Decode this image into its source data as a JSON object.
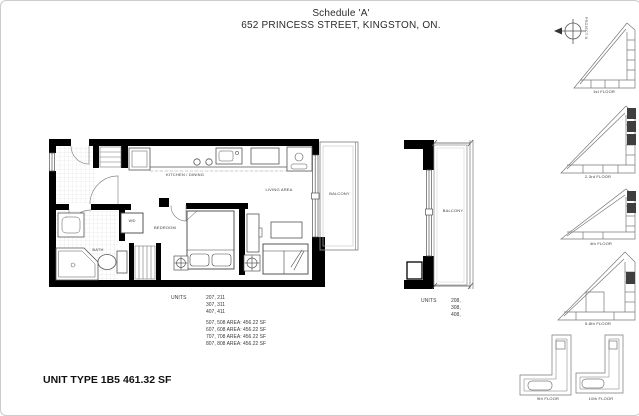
{
  "title": {
    "schedule": "Schedule 'A'",
    "address": "652 PRINCESS STREET, KINGSTON, ON."
  },
  "plan_labels": {
    "kitchen_dining": "KITCHEN / DINING",
    "living_area": "LIVING AREA",
    "bedroom": "BEDROOM",
    "bath": "BATH",
    "washer_dryer": "W/D",
    "balcony": "BALCONY"
  },
  "section_labels": {
    "balcony": "BALCONY"
  },
  "units_left": {
    "label": "UNITS",
    "lines": [
      "207, 211",
      "307, 311",
      "407, 411"
    ],
    "area_lines": [
      "507, 508 AREA: 456.22 SF",
      "607, 608 AREA: 456.22 SF",
      "707, 708 AREA: 456.22 SF",
      "807, 808 AREA: 456.22 SF"
    ]
  },
  "units_right": {
    "label": "UNITS",
    "lines": [
      "208,",
      "308,",
      "408,"
    ]
  },
  "footer": {
    "unit_type": "UNIT TYPE 1B5",
    "area": "461.32 SF"
  },
  "north_arrow": {
    "label": "PROJECT N"
  },
  "keyplans": [
    {
      "label": "1st FLOOR"
    },
    {
      "label": "2-3rd FLOOR"
    },
    {
      "label": "4th FLOOR"
    },
    {
      "label": "5-8th FLOOR"
    },
    {
      "label": "9th FLOOR"
    },
    {
      "label": "10th FLOOR"
    }
  ],
  "colors": {
    "wall": "#000000",
    "line": "#666666",
    "light_line": "#c9c9c9",
    "highlight": "#3f3f3f",
    "background": "#ffffff"
  }
}
